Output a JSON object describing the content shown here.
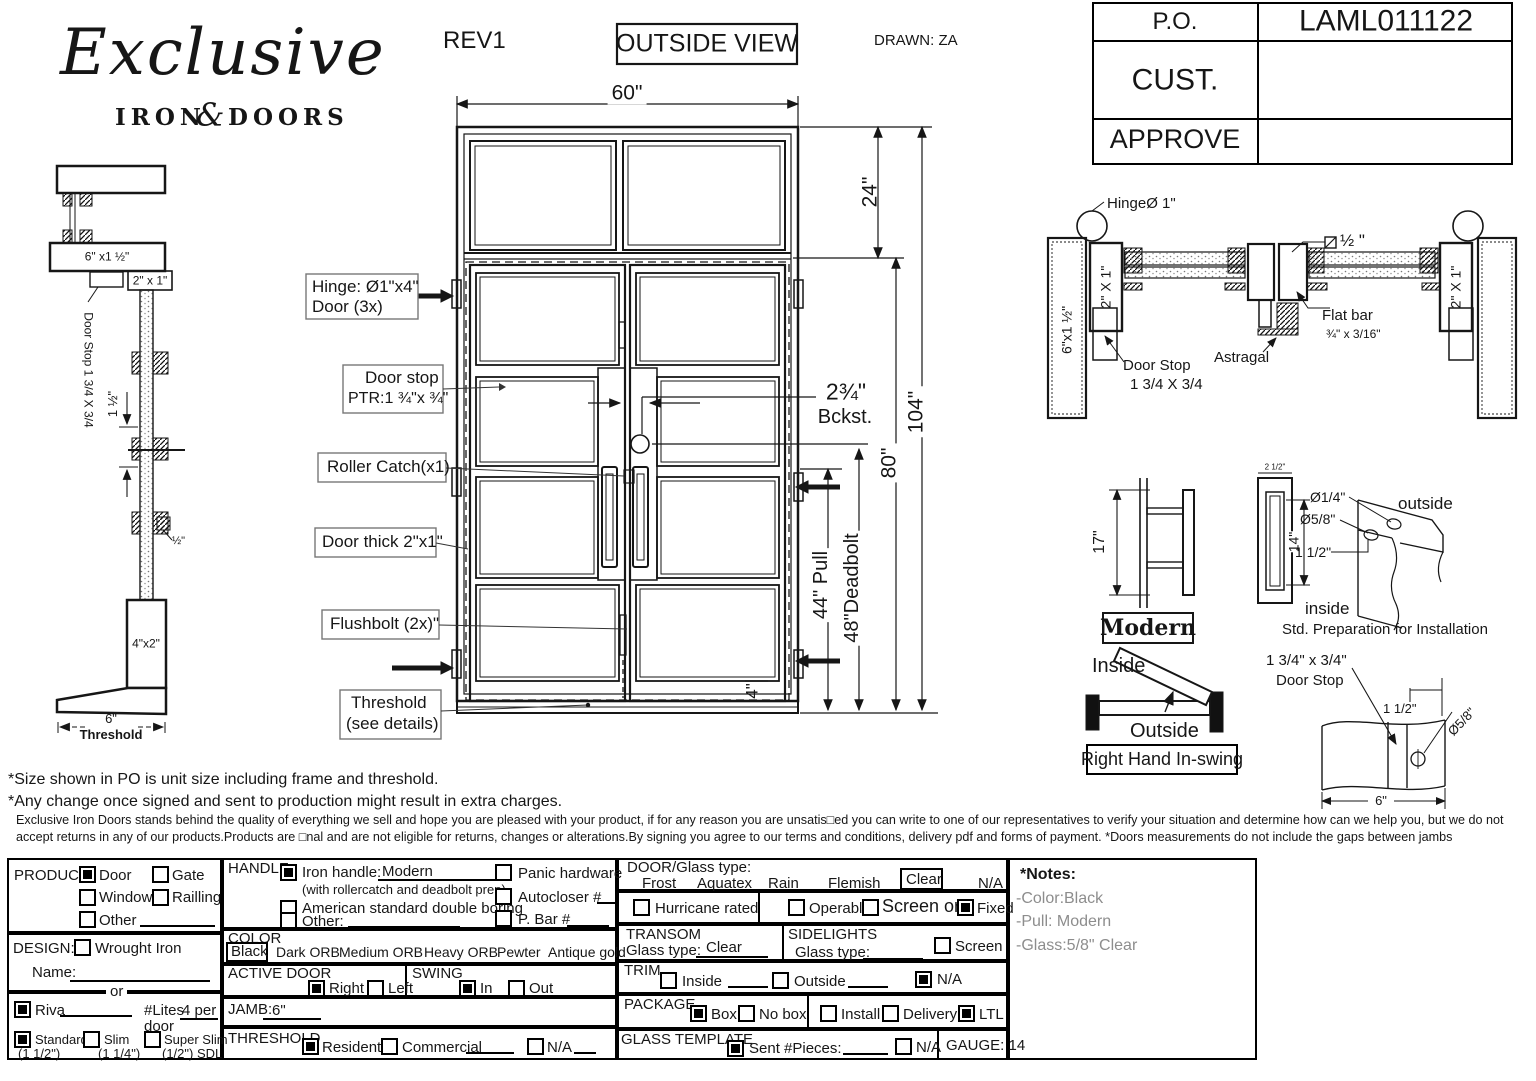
{
  "colors": {
    "ink": "#161616",
    "muted": "#8d8d8d",
    "callout_border": "#777777"
  },
  "logo": {
    "script": "Exclusive",
    "iron": "IRON",
    "ampersand": "&",
    "doors": "DOORS"
  },
  "header": {
    "rev": "REV1",
    "view_label": "OUTSIDE VIEW",
    "drawn": "DRAWN: ZA"
  },
  "po_table": [
    {
      "label": "P.O.",
      "value": "LAML011122"
    },
    {
      "label": "CUST.",
      "value": ""
    },
    {
      "label": "APPROVE",
      "value": ""
    }
  ],
  "elevation": {
    "dims": {
      "width": "60\"",
      "transom": "24\"",
      "overall": "104\"",
      "door": "80\"",
      "pull": "44\" Pull",
      "deadbolt": "48\"Deadbolt",
      "backset": "2¾\"",
      "backset_label": "Bckst.",
      "bottom_rail": "4\""
    },
    "callouts": {
      "hinge1": "Hinge: Ø1\"x4\"",
      "hinge2": "Door (3x)",
      "doorstop1": "Door stop",
      "doorstop2": "PTR:1 ¾\"x ¾\"",
      "roller": "Roller Catch(x1)",
      "thick": "Door thick 2\"x1\"",
      "flushbolt": "Flushbolt (2x)\"",
      "threshold1": "Threshold",
      "threshold2": "(see details)"
    }
  },
  "left_section": {
    "head": "6\" x1 ½\"",
    "jamb": "2\" x 1\"",
    "doorstop": "Door Stop 1 3/4 X 3/4",
    "gap": "1 ½\"",
    "half": "½\"",
    "sill": "4\"x2\"",
    "width": "6\"",
    "caption": "Threshold"
  },
  "jamb_section": {
    "hinge": "HingeØ 1\"",
    "left_jamb": "6\"x1 ½\"",
    "tube_left": "2\" X 1\"",
    "tube_right": "2\" X 1\"",
    "half": "½ \"",
    "flat1": "Flat bar",
    "flat2": "¾\" x 3/16\"",
    "astragal": "Astragal",
    "doorstop1": "Door Stop",
    "doorstop2": "1 3/4 X 3/4"
  },
  "handle_detail": {
    "height": "17\"",
    "slot": "14\"",
    "top": "2 1/2\"",
    "name": "Modern"
  },
  "prep_detail": {
    "d1": "Ø1/4\"",
    "d2": "Ø5/8\"",
    "d3": "1 1/2\"",
    "outside": "outside",
    "inside": "inside",
    "caption": "Std. Preparation for Installation"
  },
  "swing_detail": {
    "inside": "Inside",
    "outside": "Outside",
    "caption": "Right Hand In-swing"
  },
  "stop_detail": {
    "l1": "1 3/4\" x 3/4\"",
    "l2": "Door Stop",
    "d1": "1 1/2\"",
    "d2": "Ø5/8\"",
    "d3": "6\""
  },
  "disclaimer": {
    "line1": "*Size shown in PO is unit size including frame and threshold.",
    "line2": "*Any change once signed and sent to production might result in extra charges.",
    "para": "Exclusive Iron Doors stands behind the quality of everything we sell and hope you are pleased with your product, if for any reason you are unsatis□ed you can write to one of our representatives to verify your situation and determine how can we help you, but we do not accept returns in any of our products.Products are □nal and are not eligible for returns, changes or alterations.By signing you agree to our terms and conditions, delivery pdf and forms of payment. *Doors measurements do not include the gaps between jambs"
  },
  "form": {
    "product": {
      "label": "PRODUCT:",
      "door": {
        "label": "Door",
        "checked": true
      },
      "gate": {
        "label": "Gate",
        "checked": false
      },
      "window": {
        "label": "Window",
        "checked": false
      },
      "railling": {
        "label": "Railling",
        "checked": false
      },
      "other": {
        "label": "Other",
        "checked": false
      }
    },
    "design": {
      "label": "DESIGN:",
      "wrought": {
        "label": "Wrought Iron",
        "checked": false
      },
      "name_label": "Name:",
      "or_label": "or"
    },
    "riva": {
      "label": "Riva",
      "checked": true,
      "lites_label": "#Lites",
      "lites_value": "4 per",
      "lites_value2": "door"
    },
    "thickness": {
      "standard": {
        "label": "Standard",
        "sub": "(1 1/2\")",
        "checked": true
      },
      "slim": {
        "label": "Slim",
        "sub": "(1 1/4\")",
        "checked": false
      },
      "superslim": {
        "label": "Super Slim",
        "sub": "(1/2\") SDL",
        "checked": false
      }
    },
    "handle": {
      "label": "HANDLE",
      "iron": {
        "label": "Iron handle:",
        "value": "Modern",
        "sub": "(with rollercatch and deadbolt prep)",
        "checked": true
      },
      "american": {
        "label": "American standard double boring",
        "checked": false
      },
      "other": {
        "label": "Other:",
        "checked": false
      },
      "panic": {
        "label": "Panic hardware",
        "checked": false
      },
      "autocloser": {
        "label": "Autocloser #",
        "checked": false
      },
      "pbar": {
        "label": "P. Bar #",
        "checked": false
      }
    },
    "color": {
      "label": "COLOR",
      "selected": "Black",
      "options": [
        "Dark ORB",
        "Medium ORB",
        "Heavy ORB",
        "Pewter",
        "Antique gold"
      ]
    },
    "active_door": {
      "label": "ACTIVE DOOR",
      "right": {
        "label": "Right",
        "checked": true
      },
      "left": {
        "label": "Left",
        "checked": false
      }
    },
    "swing": {
      "label": "SWING",
      "in": {
        "label": "In",
        "checked": true
      },
      "out": {
        "label": "Out",
        "checked": false
      }
    },
    "jamb": {
      "label": "JAMB:",
      "value": "6\""
    },
    "threshold": {
      "label": "THRESHOLD",
      "residential": {
        "label": "Residential",
        "checked": true
      },
      "commercial": {
        "label": "Commercial",
        "checked": false
      },
      "na": {
        "label": "N/A",
        "checked": false
      }
    },
    "door_glass": {
      "label": "DOOR/Glass type:",
      "options": [
        "Frost",
        "Aquatex",
        "Rain",
        "Flemish"
      ],
      "selected": "Clear",
      "na": "N/A"
    },
    "hurricane": {
      "label": "Hurricane rated",
      "checked": false
    },
    "screen_row": {
      "operable": {
        "label": "Operable",
        "checked": false
      },
      "screen": {
        "label": "Screen or",
        "checked": false
      },
      "fixed": {
        "label": "Fixed",
        "checked": true
      }
    },
    "transom": {
      "label": "TRANSOM",
      "glass_label": "Glass type:",
      "value": "Clear"
    },
    "sidelights": {
      "label": "SIDELIGHTS",
      "glass_label": "Glass type:",
      "screen": {
        "label": "Screen",
        "checked": false
      }
    },
    "trim": {
      "label": "TRIM",
      "inside": {
        "label": "Inside",
        "checked": false
      },
      "outside": {
        "label": "Outside",
        "checked": false
      },
      "na": {
        "label": "N/A",
        "checked": true
      }
    },
    "package": {
      "label": "PACKAGE",
      "box": {
        "label": "Box",
        "checked": true
      },
      "nobox": {
        "label": "No box",
        "checked": false
      },
      "install": {
        "label": "Install",
        "checked": false
      },
      "delivery": {
        "label": "Delivery",
        "checked": false
      },
      "ltl": {
        "label": "LTL",
        "checked": true
      }
    },
    "glass_template": {
      "label": "GLASS TEMPLATE",
      "sent": {
        "label": "Sent #Pieces:",
        "checked": true
      },
      "na": {
        "label": "N/A",
        "checked": false
      },
      "gauge": "GAUGE: 14"
    },
    "notes": {
      "title": "*Notes:",
      "items": [
        "-Color:Black",
        "-Pull: Modern",
        "-Glass:5/8\" Clear"
      ]
    }
  }
}
